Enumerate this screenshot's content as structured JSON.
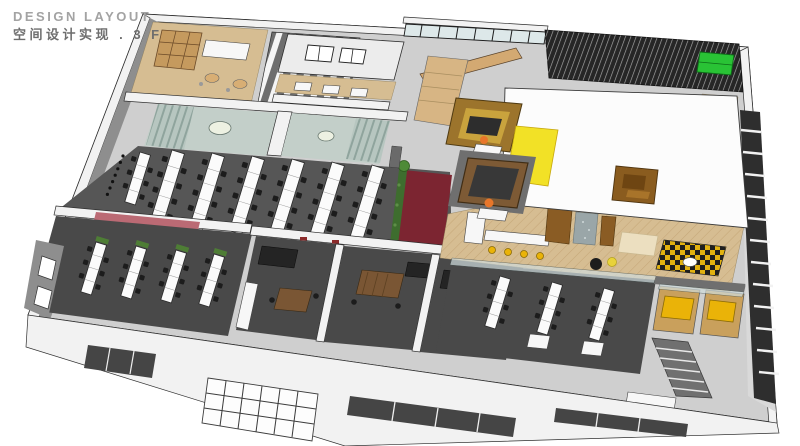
{
  "header": {
    "title_line1": "DESIGN LAYOUT",
    "title_line2": "空间设计实现 . 3 F"
  },
  "colors": {
    "bg": "#ffffff",
    "line": "#2f2f2f",
    "title-en": "#a3a3a3",
    "title-zh": "#6e6e6e",
    "wall-white": "#f2f2f2",
    "wall-gray": "#8e8e8e",
    "floor-base": "#cfcfcf",
    "carpet": "#565656",
    "carpet-dark": "#494949",
    "desk-white": "#fbfbfb",
    "chair-black": "#1c1c1c",
    "tan-floor": "#d6bd92",
    "wood-light": "#d3a972",
    "wood-dark": "#8a5c24",
    "wood-mid": "#7a5634",
    "pale-meeting": "#c3cfc9",
    "glass": "#cfdcdd",
    "accent-red": "#7c2531",
    "accent-pink": "#bb6a74",
    "accent-yellow": "#f2e126",
    "stool-yellow": "#eab308",
    "plant-green": "#4e7d35",
    "sofa-green": "#29c335",
    "louver-dark": "#262626",
    "person-orange": "#e8762a",
    "slab-white": "#fcfcfc"
  },
  "scene": {
    "type": "axonometric-3d-office-floor-plan",
    "floor": "3F",
    "zones": [
      {
        "name": "pantry-break-room",
        "floor_color": "tan-floor"
      },
      {
        "name": "locker-shelf-room",
        "floor_color": "wall-gray"
      },
      {
        "name": "focus-table-row",
        "floor_color": "tan-floor"
      },
      {
        "name": "glazed-corridor",
        "floor_color": "glass"
      },
      {
        "name": "louvered-terrace",
        "floor_color": "louver-dark"
      },
      {
        "name": "large-white-roof-slab",
        "floor_color": "slab-white"
      },
      {
        "name": "meeting-room-1",
        "floor_color": "pale-meeting"
      },
      {
        "name": "meeting-room-2",
        "floor_color": "pale-meeting"
      },
      {
        "name": "open-office-west",
        "floor_color": "carpet"
      },
      {
        "name": "planted-red-walkway",
        "floor_color": "accent-red"
      },
      {
        "name": "team-room-southwest",
        "floor_color": "carpet-dark"
      },
      {
        "name": "private-office-a",
        "floor_color": "carpet-dark"
      },
      {
        "name": "private-office-b",
        "floor_color": "carpet-dark"
      },
      {
        "name": "private-office-c",
        "floor_color": "carpet-dark"
      },
      {
        "name": "wood-portal-booths",
        "floor_color": "wood-dark"
      },
      {
        "name": "reception-cafe-herringbone",
        "floor_color": "tan-floor"
      },
      {
        "name": "open-office-southeast",
        "floor_color": "carpet-dark"
      },
      {
        "name": "yellow-phone-booths",
        "floor_color": "stool-yellow"
      },
      {
        "name": "stair-escalator-east",
        "floor_color": "wall-gray"
      }
    ]
  }
}
